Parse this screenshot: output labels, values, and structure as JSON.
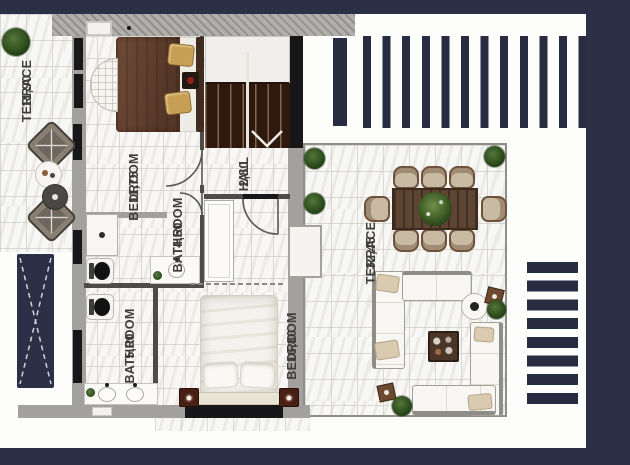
{
  "plan_title": "villa-upper-floor-plan",
  "rooms": [
    {
      "name": "TERRACE",
      "area": "11,90"
    },
    {
      "name": "BEDROOM",
      "area": "11,75"
    },
    {
      "name": "HALL",
      "area": "2,80"
    },
    {
      "name": "BATHROOM",
      "area": "4,50"
    },
    {
      "name": "BATHROOM",
      "area": "5,00"
    },
    {
      "name": "BEDROOM",
      "area": "16,80"
    },
    {
      "name": "TERRACE",
      "area": "32,45"
    }
  ],
  "colors": {
    "frame_navy": "#2b3046",
    "pergola_stripe_navy": "#272c40",
    "wall_gray": "#a3a19e",
    "stairs_brown": "#2f190d",
    "bed_blanket_brown": "#6f4b38",
    "dining_table_brown": "#5d4433",
    "sofa_white": "#f7f6f2",
    "plant_green": "#2e4d1d",
    "tile_floor": "#f1f0ed",
    "label_text": "#3e3d3b"
  }
}
